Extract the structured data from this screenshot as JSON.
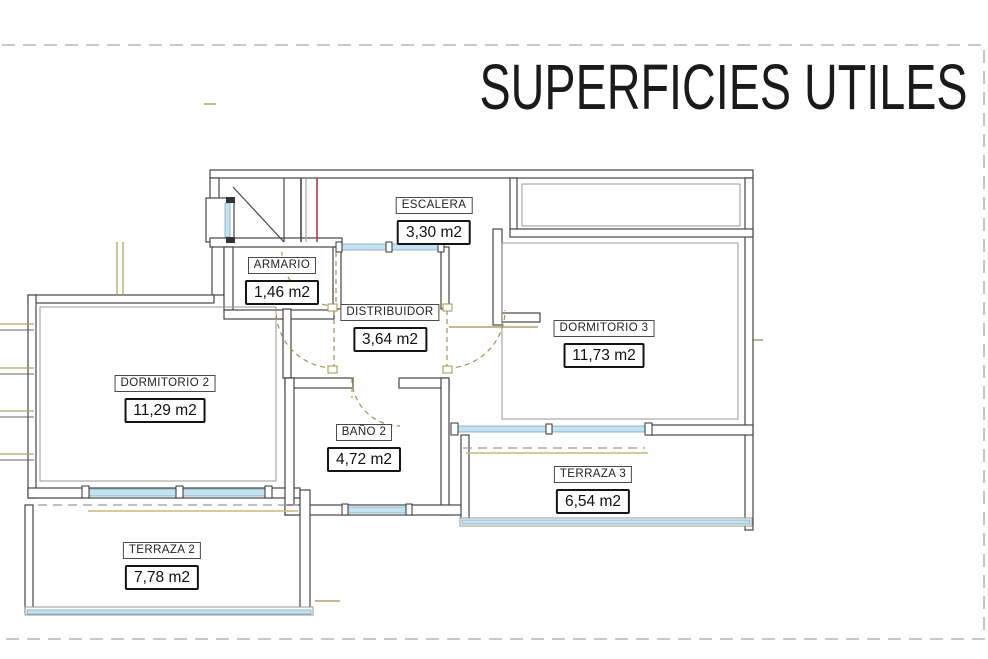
{
  "title": "SUPERFICIES UTILES",
  "rooms": {
    "escalera": {
      "name": "ESCALERA",
      "area": "3,30 m2"
    },
    "armario": {
      "name": "ARMARIO",
      "area": "1,46 m2"
    },
    "distribuidor": {
      "name": "DISTRIBUIDOR",
      "area": "3,64 m2"
    },
    "dormitorio3": {
      "name": "DORMITORIO 3",
      "area": "11,73 m2"
    },
    "dormitorio2": {
      "name": "DORMITORIO 2",
      "area": "11,29 m2"
    },
    "bano2": {
      "name": "BAÑO 2",
      "area": "4,72 m2"
    },
    "terraza3": {
      "name": "TERRAZA 3",
      "area": "6,54 m2"
    },
    "terraza2": {
      "name": "TERRAZA 2",
      "area": "7,78 m2"
    }
  },
  "colors": {
    "text": "#1a1a1a",
    "wall": "#454545",
    "wall-light": "#979797",
    "window": "#c3e3f0",
    "window-edge": "#7fa8bb",
    "door": "#a8904a",
    "tan": "#c9b97c",
    "stair-red": "#b23c3c",
    "border-dash": "#b5b5b5"
  }
}
